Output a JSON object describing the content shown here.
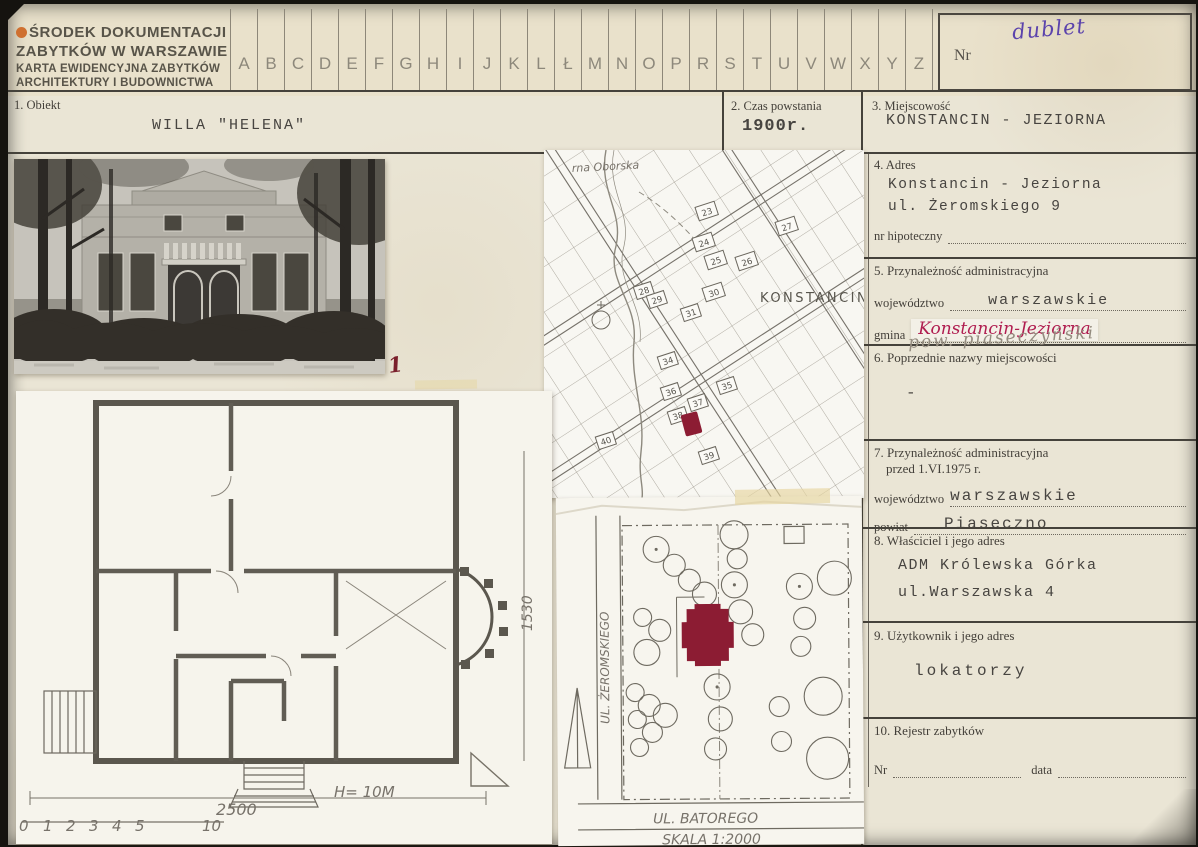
{
  "header": {
    "org_line1": "ŚRODEK DOKUMENTACJI",
    "org_line2": "ZABYTKÓW W WARSZAWIE",
    "org_line3": "KARTA EWIDENCYJNA ZABYTKÓW",
    "org_line4": "ARCHITEKTURY I BUDOWNICTWA",
    "alphabet": [
      "A",
      "B",
      "C",
      "D",
      "E",
      "F",
      "G",
      "H",
      "I",
      "J",
      "K",
      "L",
      "Ł",
      "M",
      "N",
      "O",
      "P",
      "R",
      "S",
      "T",
      "U",
      "V",
      "W",
      "X",
      "Y",
      "Z"
    ],
    "nr_label": "Nr",
    "nr_value": "dublet",
    "ink_purple": "#5b43ac",
    "ink_magenta": "#b01d50",
    "marker_red": "#8c1c33"
  },
  "fields": {
    "f1": {
      "label": "1. Obiekt",
      "value": "WILLA \"HELENA\""
    },
    "f2": {
      "label": "2. Czas powstania",
      "value": "1900r."
    },
    "f3": {
      "label": "3. Miejscowość",
      "value": "KONSTANCIN - JEZIORNA"
    },
    "f4": {
      "label": "4. Adres",
      "value_line1": "Konstancin - Jeziorna",
      "value_line2": "ul. Żeromskiego 9",
      "sub_label": "nr hipoteczny"
    },
    "f5": {
      "label": "5. Przynależność administracyjna",
      "wojewodztwo_label": "województwo",
      "wojewodztwo_value": "warszawskie",
      "gmina_label": "gmina",
      "gmina_value": "Konstancin-Jeziorna",
      "pencil_note": "pow. piaseczyński"
    },
    "f6": {
      "label": "6. Poprzednie nazwy miejscowości",
      "value": "-"
    },
    "f7": {
      "label_line1": "7. Przynależność administracyjna",
      "label_line2": "przed 1.VI.1975 r.",
      "wojewodztwo_label": "województwo",
      "wojewodztwo_value": "warszawskie",
      "powiat_label": "powiat",
      "powiat_value": "Piaseczno"
    },
    "f8": {
      "label": "8. Właściciel i jego adres",
      "value_line1": "ADM Królewska Górka",
      "value_line2": "ul.Warszawska 4"
    },
    "f9": {
      "label": "9. Użytkownik i jego adres",
      "value": "lokatorzy"
    },
    "f10": {
      "label": "10. Rejestr zabytków",
      "nr_label": "Nr",
      "data_label": "data"
    }
  },
  "photo": {
    "annotation": "1"
  },
  "map": {
    "street_label": "rna Oborska",
    "city_label": "KONSTANCIN",
    "blocks": [
      "23",
      "27",
      "24",
      "25",
      "26",
      "28",
      "29",
      "30",
      "31",
      "34",
      "35",
      "36",
      "37",
      "38",
      "40",
      "39"
    ]
  },
  "floor_plan": {
    "dim_width": "2500",
    "height_label": "H= 10M",
    "dim_height": "1530",
    "scale_ticks": [
      "0",
      "1",
      "2",
      "3",
      "4",
      "5",
      "10"
    ]
  },
  "site_plan": {
    "street_left": "UL. ŻEROMSKIEGO",
    "street_bottom": "UL. BATOREGO",
    "scale_label": "SKALA 1:2000"
  }
}
